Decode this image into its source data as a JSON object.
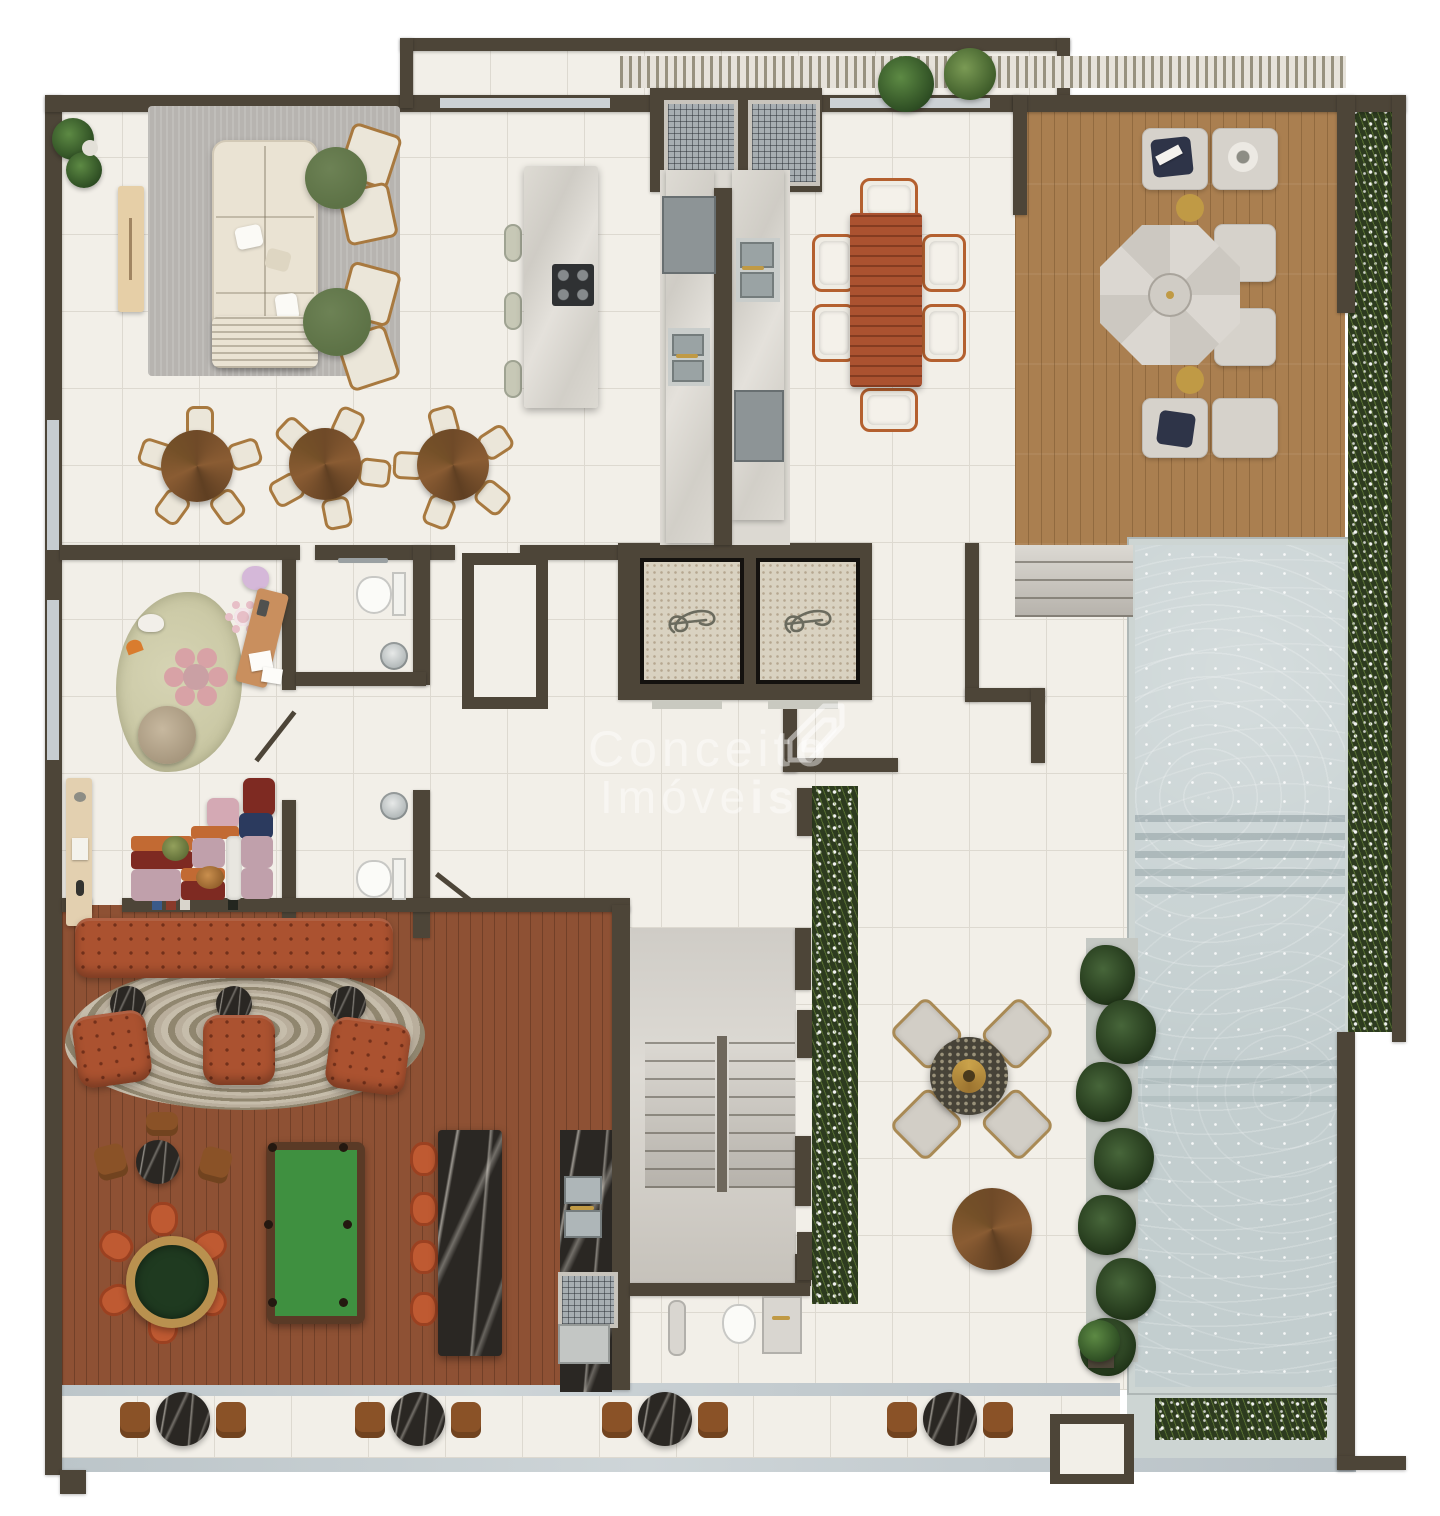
{
  "watermark": {
    "line1": {
      "light": "Concei",
      "bold": "to"
    },
    "line2": {
      "light": "Imóve",
      "bold": "is"
    }
  },
  "icons": {
    "elevator_symbol": "stylized-loop-elevator-icon",
    "brand_logo": "conceito-imoveis-diamond-logo"
  },
  "colors": {
    "wall": "#4d4538",
    "tile": "#f2efe8",
    "tileline": "#ddd9d0",
    "deck": "#aa7f50",
    "rwood": "#8e5134",
    "pool": "#c3cecf",
    "pooltile": "#cdd5d3",
    "greentbl": "#5d7246",
    "terracotta": "#ab5230",
    "sofa": "#eae3d3",
    "ruggray": "#b7b4b0",
    "kidsrug": "#c9c7a3",
    "planter": "#2d3b1f",
    "gold": "#c09a45",
    "stair": "#d5d2cc",
    "terrazzo": "#d9d2c1",
    "orange": "#bf5a32",
    "wm": "rgba(255,255,255,0.45)"
  }
}
